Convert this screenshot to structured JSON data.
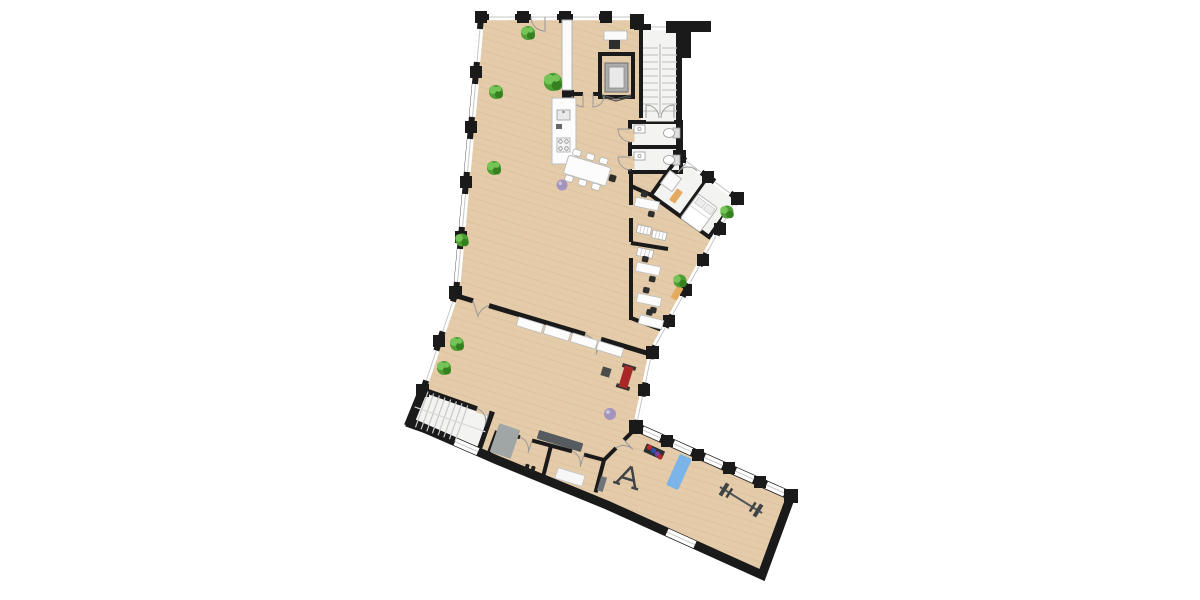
{
  "scene": {
    "description": "Top-down 2D architectural floor plan of an angled multi-wing building rendered on a white background, no text labels",
    "type": "architectural-floor-plan",
    "view": "top-down",
    "background": "#ffffff"
  },
  "colors": {
    "background": "#ffffff",
    "wall": "#1a1a1a",
    "floor_wood": "#e4cba9",
    "floor_wood_grain": "#d0b28a",
    "floor_light": "#f3f3f1",
    "window": "#ffffff",
    "window_frame": "#c6c6c6",
    "door_arc": "#9a9a9a",
    "plant": "#4f9e35",
    "plant_dark": "#35801f",
    "plant_light": "#74c457",
    "furniture_white": "#fcfcfc",
    "furniture_stroke": "#bcbcbc",
    "chair_dark": "#2e2e2e",
    "equipment_dark": "#3f4448",
    "locker_gray": "#565b5f",
    "mat_gray": "#a0a6a6",
    "mat_blue": "#7ab4e8",
    "bench_red": "#a82828",
    "ball_purple": "#a294bd",
    "bench_tan": "#e4ab60",
    "elevator_car": "#ababab",
    "stair_tread": "#c9c9c9",
    "wedge_gray": "#70757a"
  },
  "zones": [
    {
      "name": "open-plan-room"
    },
    {
      "name": "entry-area"
    },
    {
      "name": "elevator"
    },
    {
      "name": "main-staircase"
    },
    {
      "name": "wc-area"
    },
    {
      "name": "annex-rooms"
    },
    {
      "name": "middle-room"
    },
    {
      "name": "changing-rooms"
    },
    {
      "name": "secondary-staircase"
    },
    {
      "name": "gym-wing"
    }
  ],
  "inventory": {
    "items": [
      {
        "name": "staircase",
        "count": 2
      },
      {
        "name": "elevator",
        "count": 1
      },
      {
        "name": "toilet",
        "count": 2
      },
      {
        "name": "sink",
        "count": 2
      },
      {
        "name": "potted-plant",
        "count": 9
      },
      {
        "name": "office-desk",
        "count": 4
      },
      {
        "name": "desk-chair",
        "count": 7
      },
      {
        "name": "shelf-unit",
        "count": 3
      },
      {
        "name": "kitchen-island",
        "count": 1
      },
      {
        "name": "meeting-table",
        "count": 1
      },
      {
        "name": "meeting-chair",
        "count": 7
      },
      {
        "name": "sideboard",
        "count": 4
      },
      {
        "name": "credenza",
        "count": 1
      },
      {
        "name": "printer",
        "count": 1
      },
      {
        "name": "bed",
        "count": 1
      },
      {
        "name": "side-table",
        "count": 1
      },
      {
        "name": "tan-bench",
        "count": 2
      },
      {
        "name": "locker-bench",
        "count": 1
      },
      {
        "name": "weight-bench",
        "count": 1
      },
      {
        "name": "exercise-ball",
        "count": 2
      },
      {
        "name": "gray-floor-mat",
        "count": 1
      },
      {
        "name": "white-bench",
        "count": 1
      },
      {
        "name": "incline-wedge",
        "count": 1
      },
      {
        "name": "squat-stand",
        "count": 1
      },
      {
        "name": "dumbbell-rack",
        "count": 1
      },
      {
        "name": "dumbbell-pair",
        "count": 1
      },
      {
        "name": "barbell",
        "count": 1
      },
      {
        "name": "yoga-mat",
        "count": 1
      }
    ]
  }
}
